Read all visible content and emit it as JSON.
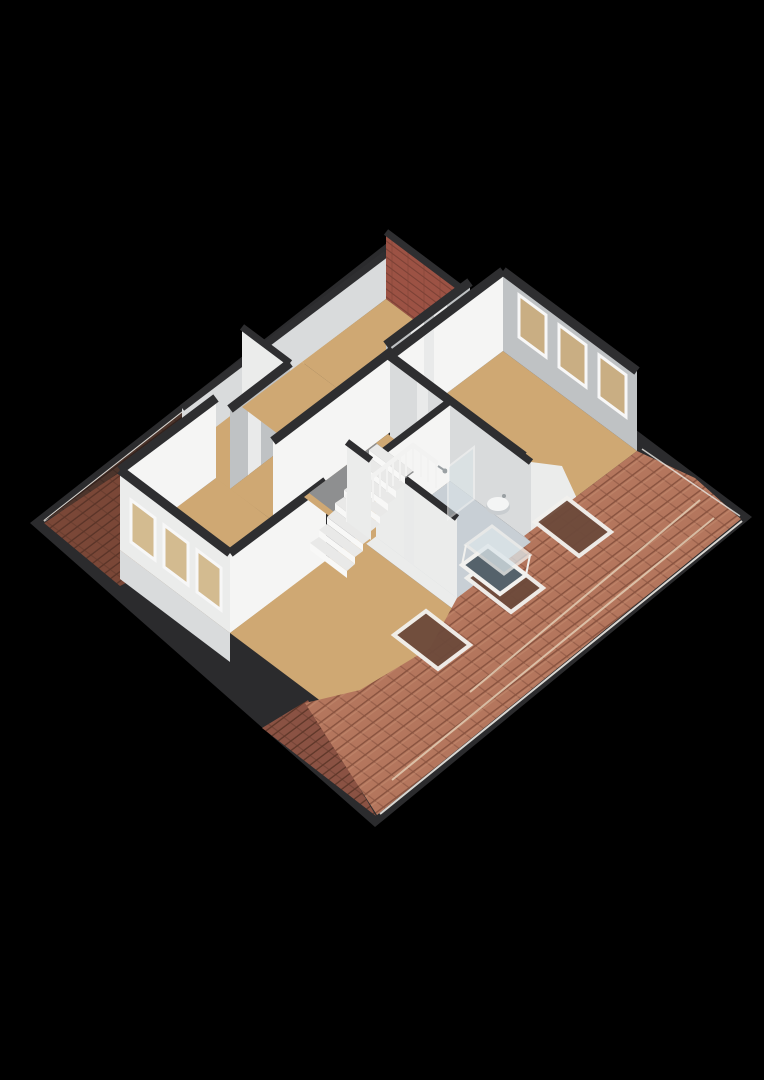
{
  "canvas": {
    "width": 764,
    "height": 1080,
    "background": "#000000"
  },
  "scene": {
    "kind": "isometric-3d-floor-plan",
    "inventory": {
      "skylights_nw_slope": 2,
      "skylights_se_slope_closed": 3,
      "roof_windows_open": 1,
      "windows_ne_gable_wall": 3,
      "windows_sw_gable_wall": 3,
      "stair_steps": 8,
      "stair_balusters": 14,
      "tan_floor_rooms": 6,
      "bathroom_floors": 1,
      "fixtures": [
        "shower",
        "washbasin"
      ]
    }
  },
  "colors": {
    "background": "#000000",
    "eave": "#2b2b2d",
    "cap": "#2e2e30",
    "gutter": "#eceae4",
    "roof_nw_base": "#4c342b",
    "roof_nw_line": "#32211c",
    "roof_w_base": "#7a4737",
    "roof_w_line": "#5a3428",
    "roof_sw_base": "#8a5243",
    "roof_sw_line": "#5f3729",
    "roof_se_base": "#b4765d",
    "roof_se_line": "#8a5440",
    "roof_se_light": "#c68f74",
    "ridge_trim": "#e3cdb4",
    "floor_tan": "#cfa873",
    "floor_bath": "#c8cfd5",
    "wall_bright": "#f5f5f4",
    "wall_white": "#ebeceb",
    "wall_light": "#d9dbdc",
    "wall_gray": "#bfc2c4",
    "brick": "#9c5244",
    "brick_line": "#7c4135",
    "window_frame": "#f7f7f7",
    "window_glass": "#c9ae83",
    "window_glass_sw": "#d3bb90",
    "skylight_frame": "#f2f1ee",
    "skylight_glass_dark": "#4e4038",
    "skylight_glass_se": "#6d4a3b",
    "stair_hole": "#8e8f90",
    "stair_tread": "#e9e9e8",
    "stair_riser": "#f8f8f7",
    "rail": "#f2f2f1",
    "shower_glass": "#dce6ea",
    "fixture": "#f4f5f5",
    "fixture_shadow": "#c9cdd0",
    "door": "#e9eaea",
    "opening_dark": "#55626b",
    "metal": "#9aa0a3"
  }
}
